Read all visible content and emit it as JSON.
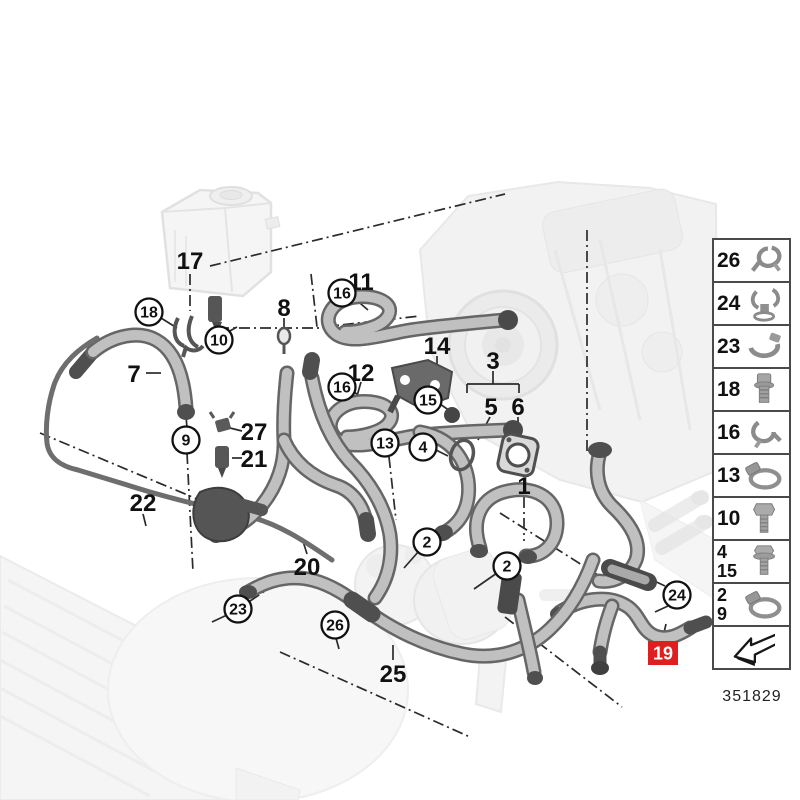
{
  "diagram": {
    "highlight_color": "#df1f1f",
    "callouts_plain": [
      {
        "label": "17",
        "x": 190,
        "y": 260
      },
      {
        "label": "8",
        "x": 284,
        "y": 307
      },
      {
        "label": "11",
        "x": 361,
        "y": 281
      },
      {
        "label": "12",
        "x": 361,
        "y": 372
      },
      {
        "label": "14",
        "x": 437,
        "y": 345
      },
      {
        "label": "3",
        "x": 493,
        "y": 360
      },
      {
        "label": "5",
        "x": 491,
        "y": 406
      },
      {
        "label": "6",
        "x": 518,
        "y": 406
      },
      {
        "label": "27",
        "x": 254,
        "y": 431
      },
      {
        "label": "21",
        "x": 254,
        "y": 458
      },
      {
        "label": "7",
        "x": 134,
        "y": 373
      },
      {
        "label": "22",
        "x": 143,
        "y": 502
      },
      {
        "label": "20",
        "x": 307,
        "y": 566
      },
      {
        "label": "25",
        "x": 393,
        "y": 673
      },
      {
        "label": "1",
        "x": 524,
        "y": 485
      }
    ],
    "callouts_circled": [
      {
        "label": "18",
        "x": 149,
        "y": 312
      },
      {
        "label": "10",
        "x": 219,
        "y": 340
      },
      {
        "label": "16",
        "x": 342,
        "y": 293
      },
      {
        "label": "16",
        "x": 342,
        "y": 387
      },
      {
        "label": "15",
        "x": 428,
        "y": 400
      },
      {
        "label": "13",
        "x": 385,
        "y": 443
      },
      {
        "label": "4",
        "x": 423,
        "y": 447
      },
      {
        "label": "9",
        "x": 186,
        "y": 440
      },
      {
        "label": "23",
        "x": 238,
        "y": 609
      },
      {
        "label": "26",
        "x": 335,
        "y": 625
      },
      {
        "label": "2",
        "x": 427,
        "y": 542
      },
      {
        "label": "2",
        "x": 507,
        "y": 566
      },
      {
        "label": "24",
        "x": 677,
        "y": 595
      }
    ],
    "callout_highlighted": {
      "label": "19",
      "x": 663,
      "y": 653
    }
  },
  "legend": {
    "rows": [
      {
        "labels": [
          "26"
        ],
        "icon": "spring-clip"
      },
      {
        "labels": [
          "24"
        ],
        "icon": "mount-clip"
      },
      {
        "labels": [
          "23"
        ],
        "icon": "band-clamp"
      },
      {
        "labels": [
          "18"
        ],
        "icon": "bolt-short"
      },
      {
        "labels": [
          "16"
        ],
        "icon": "spring-clip-2"
      },
      {
        "labels": [
          "13"
        ],
        "icon": "hose-clamp"
      },
      {
        "labels": [
          "10"
        ],
        "icon": "hex-bolt"
      },
      {
        "labels": [
          "4",
          "15"
        ],
        "icon": "flange-bolt"
      },
      {
        "labels": [
          "2",
          "9"
        ],
        "icon": "hose-clamp"
      }
    ],
    "arrow_icon": "direction-arrow",
    "part_number": "351829"
  }
}
